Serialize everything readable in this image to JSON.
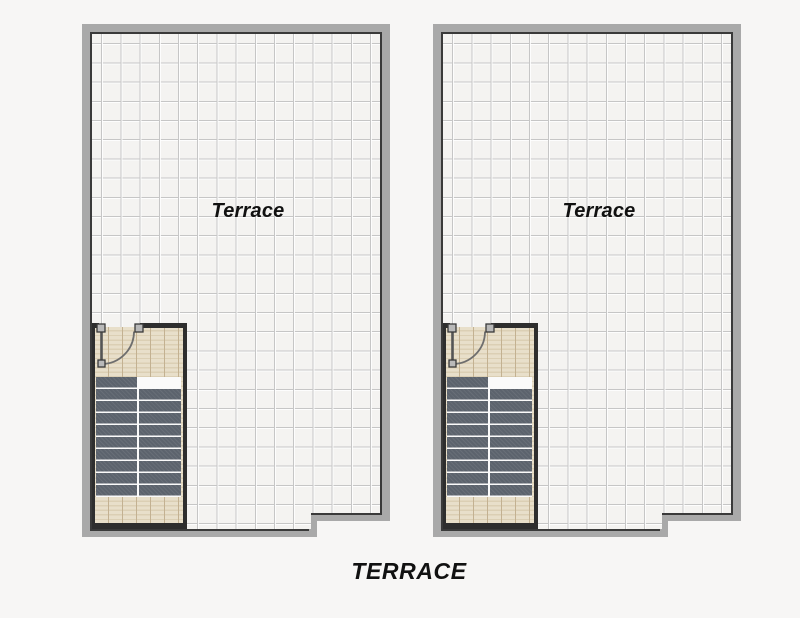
{
  "page": {
    "background": "#f7f6f5",
    "footer_label": "TERRACE"
  },
  "plans": [
    {
      "id": "left",
      "room_label": "Terrace"
    },
    {
      "id": "right",
      "room_label": "Terrace"
    }
  ],
  "stairs": {
    "left_column_steps": 10,
    "right_column_steps": 9
  },
  "colors": {
    "page-bg": "#f7f6f5",
    "wall-gray": "#a9a9a9",
    "wall-line": "#3a3a3a",
    "tile-bg": "#f4f3f1",
    "tile-line": "#c6c6c6",
    "inner-wall": "#2e2e2e",
    "wood-base": "#e8dfca",
    "wood-stripe": "#dbcfb4",
    "wood-seam": "#c3b191",
    "tread": "#5c636d",
    "tread-gap": "#fafafa",
    "door-stroke": "#6e6e6e",
    "jamb-fill": "#b9b9b9",
    "label-color": "#111111"
  }
}
